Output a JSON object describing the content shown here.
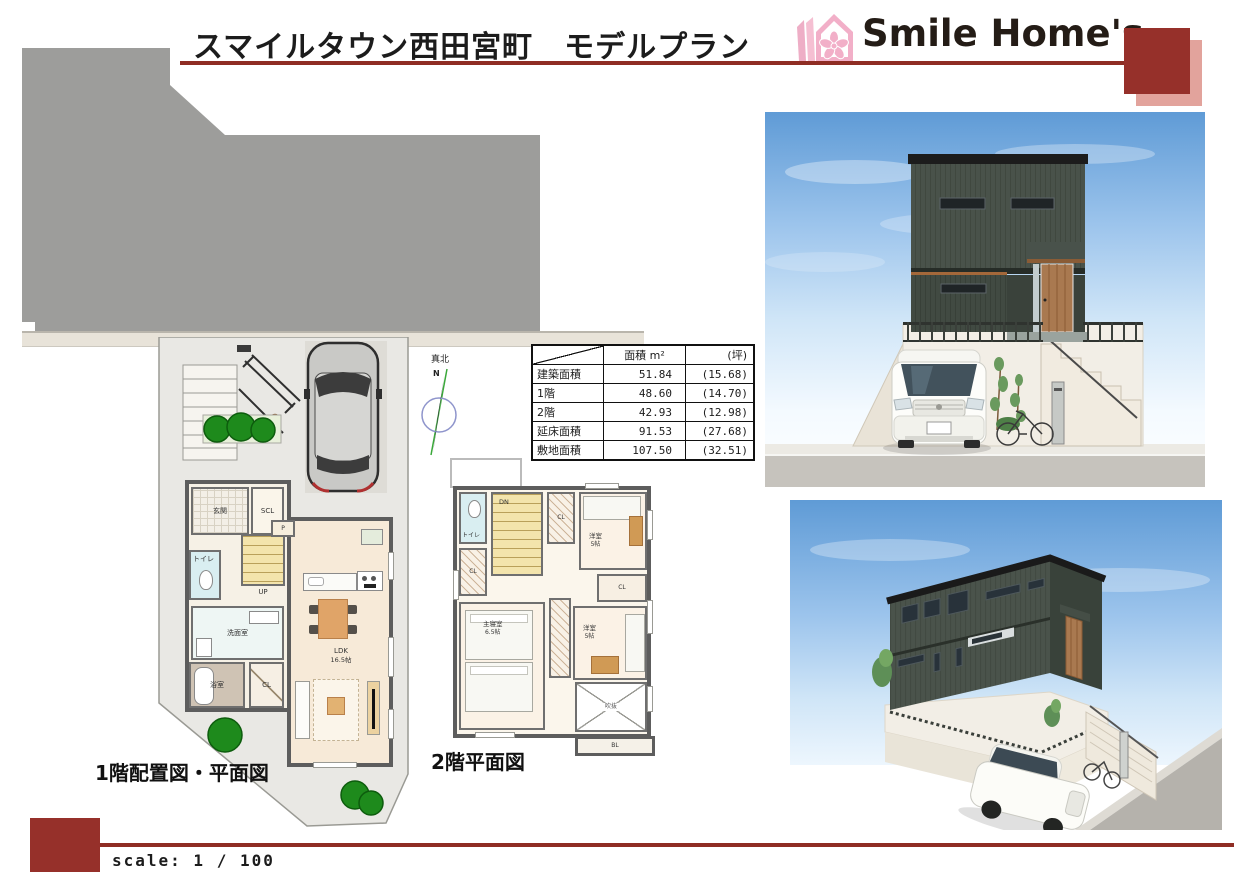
{
  "colors": {
    "accent_red": "#96302a",
    "accent_pink": "#e2a39c",
    "house_green": "#49524a"
  },
  "header": {
    "title": "スマイルタウン西田宮町　モデルプラン",
    "brand": "Smile Home's"
  },
  "compass": {
    "label": "真北",
    "north": "N"
  },
  "area_table": {
    "headers": {
      "area": "面積 m²",
      "tsubo": "(坪)"
    },
    "rows": [
      {
        "label": "建築面積",
        "sqm": "51.84",
        "tsubo": "(15.68)"
      },
      {
        "label": "1階",
        "sqm": "48.60",
        "tsubo": "(14.70)"
      },
      {
        "label": "2階",
        "sqm": "42.93",
        "tsubo": "(12.98)"
      },
      {
        "label": "延床面積",
        "sqm": "91.53",
        "tsubo": "(27.68)"
      },
      {
        "label": "敷地面積",
        "sqm": "107.50",
        "tsubo": "(32.51)"
      }
    ]
  },
  "floor1": {
    "caption": "1階配置図・平面図",
    "rooms": {
      "genkan": "玄関",
      "scl": "SCL",
      "pantry": "P",
      "toilet": "トイレ",
      "stairs_up": "UP",
      "washroom": "洗面室",
      "bath": "浴室",
      "closet": "CL",
      "ldk": "LDK",
      "ldk_size": "16.5帖"
    }
  },
  "floor2": {
    "caption": "2階平面図",
    "rooms": {
      "toilet": "トイレ",
      "stairs_dn": "DN",
      "closet": "CL",
      "bedroom1": "洋室",
      "bedroom1_size": "5帖",
      "bedroom2": "洋室",
      "bedroom2_size": "5帖",
      "master": "主寝室",
      "master_size": "6.5帖",
      "void": "吹抜",
      "balcony": "BL"
    }
  },
  "footer": {
    "scale": "scale: 1 / 100"
  }
}
